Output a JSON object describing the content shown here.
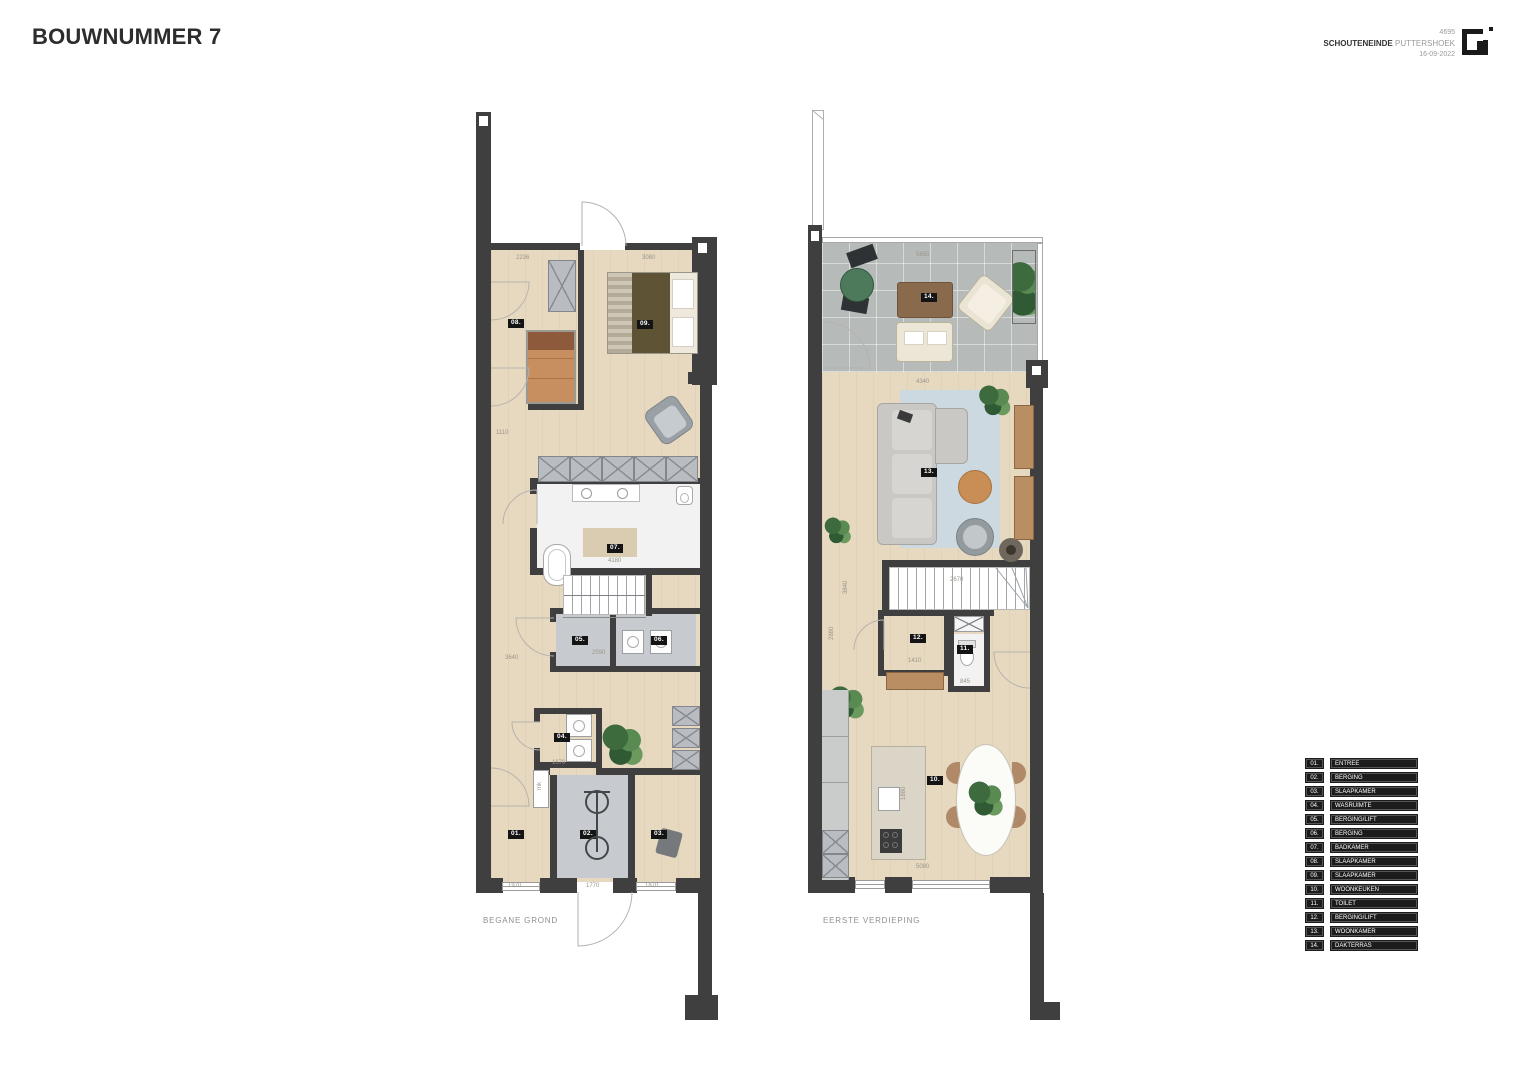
{
  "title": "BOUWNUMMER 7",
  "project": {
    "number": "4695",
    "street": "SCHOUTENEINDE",
    "city": "PUTTERSHOEK",
    "date": "16-09-2022",
    "logo": "brand-logo"
  },
  "plans": {
    "ground": {
      "caption": "BEGANE GROND",
      "tags": [
        {
          "label": "08.",
          "x": 508,
          "y": 319
        },
        {
          "label": "09.",
          "x": 637,
          "y": 320
        },
        {
          "label": "07.",
          "x": 607,
          "y": 544
        },
        {
          "label": "05.",
          "x": 572,
          "y": 636
        },
        {
          "label": "06.",
          "x": 651,
          "y": 636
        },
        {
          "label": "04.",
          "x": 554,
          "y": 733
        },
        {
          "label": "01.",
          "x": 508,
          "y": 830
        },
        {
          "label": "02.",
          "x": 580,
          "y": 830
        },
        {
          "label": "03.",
          "x": 651,
          "y": 830
        }
      ],
      "dims": [
        {
          "text": "2236",
          "x": 516,
          "y": 255,
          "rot": 0
        },
        {
          "text": "3080",
          "x": 642,
          "y": 255,
          "rot": 0
        },
        {
          "text": "1110",
          "x": 496,
          "y": 430,
          "rot": 0
        },
        {
          "text": "4180",
          "x": 608,
          "y": 558,
          "rot": 0
        },
        {
          "text": "3640",
          "x": 505,
          "y": 655,
          "rot": 0
        },
        {
          "text": "2590",
          "x": 592,
          "y": 650,
          "rot": 0
        },
        {
          "text": "1670",
          "x": 552,
          "y": 760,
          "rot": 0
        },
        {
          "text": "mk",
          "x": 537,
          "y": 790,
          "rot": -90
        },
        {
          "text": "1970",
          "x": 508,
          "y": 883,
          "rot": 0
        },
        {
          "text": "1770",
          "x": 586,
          "y": 883,
          "rot": 0
        },
        {
          "text": "1870",
          "x": 645,
          "y": 883,
          "rot": 0
        }
      ]
    },
    "first": {
      "caption": "EERSTE VERDIEPING",
      "tags": [
        {
          "label": "14.",
          "x": 921,
          "y": 293
        },
        {
          "label": "13.",
          "x": 921,
          "y": 468
        },
        {
          "label": "12.",
          "x": 910,
          "y": 634
        },
        {
          "label": "11.",
          "x": 957,
          "y": 645
        },
        {
          "label": "10.",
          "x": 927,
          "y": 776
        }
      ],
      "dims": [
        {
          "text": "5650",
          "x": 916,
          "y": 252,
          "rot": 0
        },
        {
          "text": "4340",
          "x": 916,
          "y": 379,
          "rot": 0
        },
        {
          "text": "3840",
          "x": 843,
          "y": 594,
          "rot": -90
        },
        {
          "text": "2670",
          "x": 950,
          "y": 577,
          "rot": 0
        },
        {
          "text": "2880",
          "x": 829,
          "y": 640,
          "rot": -90
        },
        {
          "text": "1410",
          "x": 908,
          "y": 658,
          "rot": 0
        },
        {
          "text": "845",
          "x": 960,
          "y": 679,
          "rot": 0
        },
        {
          "text": "1880",
          "x": 901,
          "y": 800,
          "rot": -90
        },
        {
          "text": "5080",
          "x": 916,
          "y": 864,
          "rot": 0
        }
      ]
    }
  },
  "legend": {
    "items": [
      {
        "num": "01.",
        "label": "ENTREE"
      },
      {
        "num": "02.",
        "label": "BERGING"
      },
      {
        "num": "03.",
        "label": "SLAAPKAMER"
      },
      {
        "num": "04.",
        "label": "WASRUIMTE"
      },
      {
        "num": "05.",
        "label": "BERGING/LIFT"
      },
      {
        "num": "06.",
        "label": "BERGING"
      },
      {
        "num": "07.",
        "label": "BADKAMER"
      },
      {
        "num": "08.",
        "label": "SLAAPKAMER"
      },
      {
        "num": "09.",
        "label": "SLAAPKAMER"
      },
      {
        "num": "10.",
        "label": "WOONKEUKEN"
      },
      {
        "num": "11.",
        "label": "TOILET"
      },
      {
        "num": "12.",
        "label": "BERGING/LIFT"
      },
      {
        "num": "13.",
        "label": "WOONKAMER"
      },
      {
        "num": "14.",
        "label": "DAKTERRAS"
      }
    ]
  },
  "colors": {
    "wall": "#3f3f3f",
    "wood": "#e7d9c0",
    "terrace": "#b6bbb9",
    "grayroom": "#c7cbcf",
    "bath": "#f1f2f1",
    "rug": "#cdd9e1",
    "legendbg": "#1c1c1c",
    "tagbg": "#141414"
  }
}
